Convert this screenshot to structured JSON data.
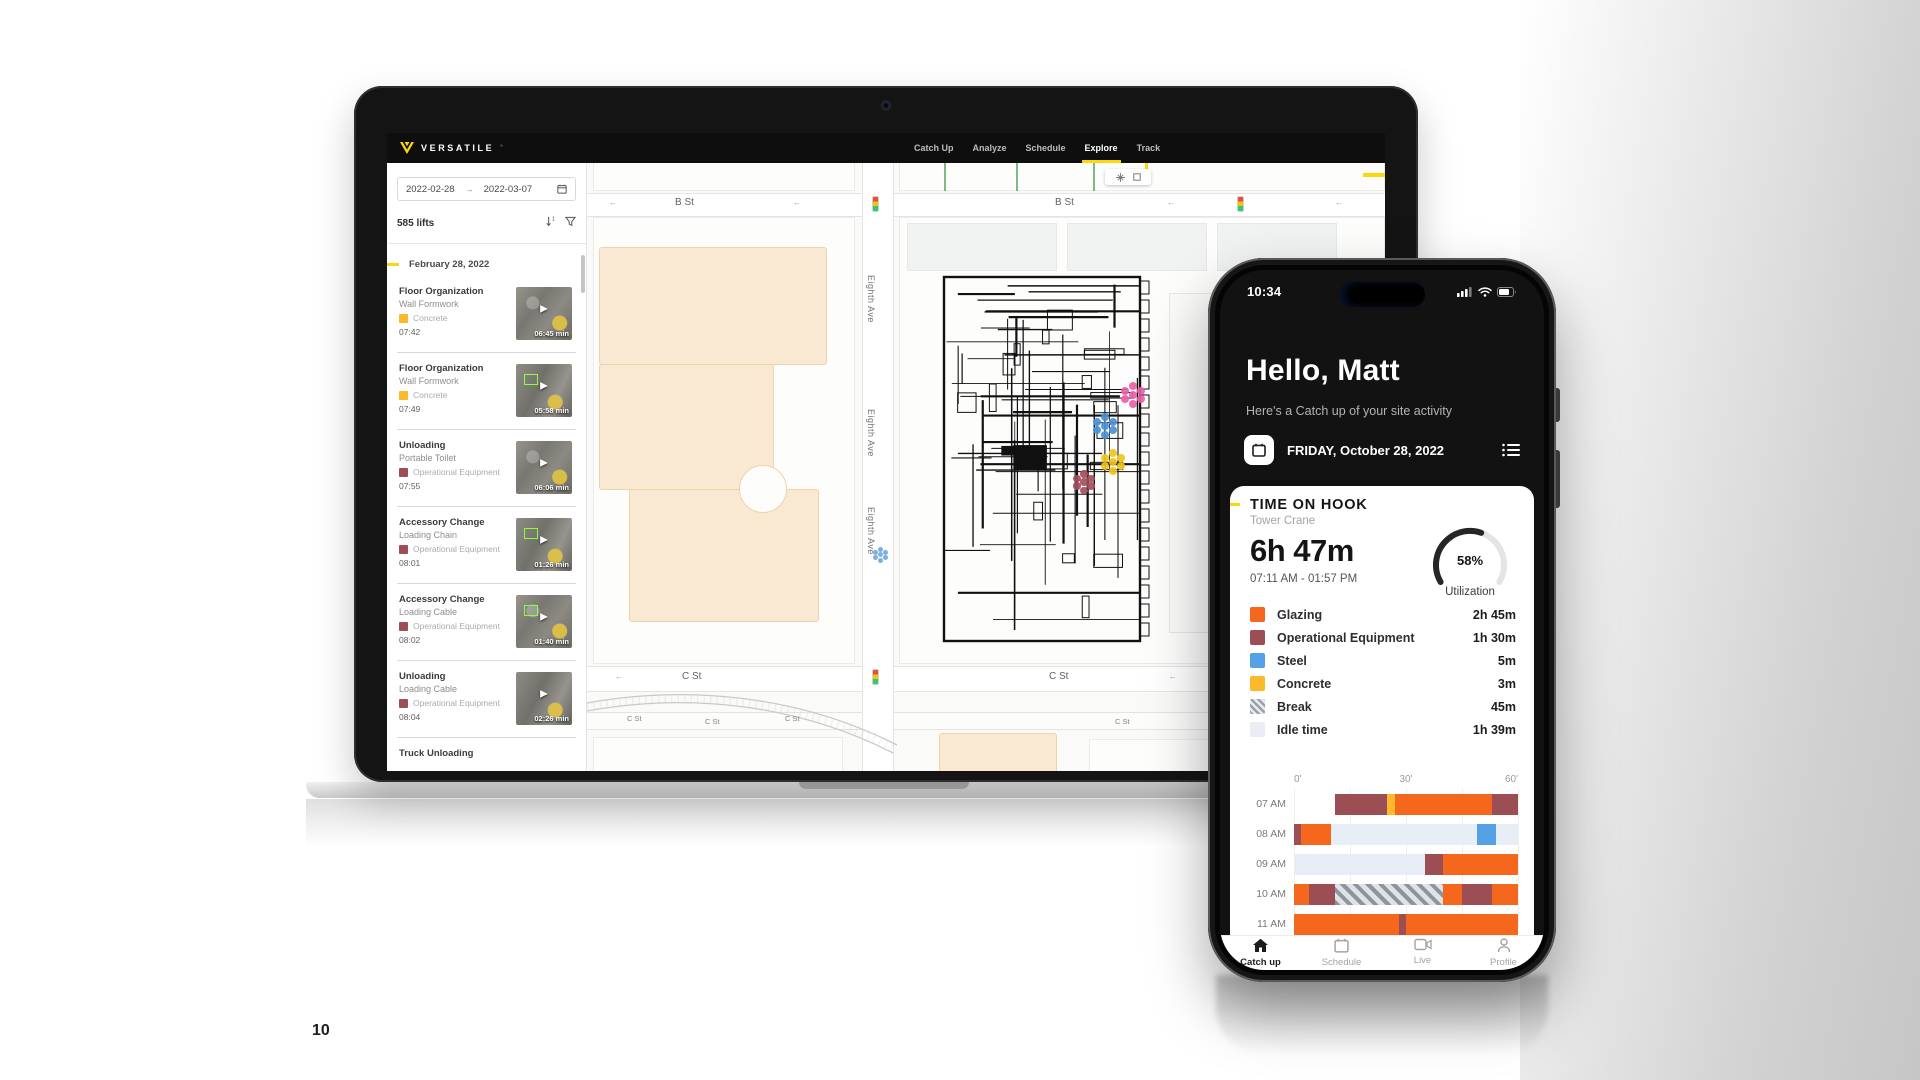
{
  "page": {
    "number": "10"
  },
  "colors": {
    "accent_yellow": "#FFD60A",
    "glazing": "#F4671C",
    "operational_equipment": "#9B4F55",
    "steel": "#54A1E6",
    "concrete": "#FCB92B",
    "break_stripe": "#99A0A8",
    "idle": "#E8EEF5"
  },
  "laptop": {
    "brand": "VERSATILE",
    "brand_mark": "°",
    "nav_items": [
      {
        "label": "Catch Up",
        "active": false
      },
      {
        "label": "Analyze",
        "active": false
      },
      {
        "label": "Schedule",
        "active": false
      },
      {
        "label": "Explore",
        "active": true
      },
      {
        "label": "Track",
        "active": false
      }
    ],
    "sidebar": {
      "date_from": "2022-02-28",
      "date_to": "2022-03-07",
      "lift_count": "585 lifts",
      "group_date": "February 28, 2022",
      "items": [
        {
          "title": "Floor Organization",
          "subtitle": "Wall Formwork",
          "category": "Concrete",
          "category_color": "#FCB92B",
          "time": "07:42",
          "duration": "06:45 min"
        },
        {
          "title": "Floor Organization",
          "subtitle": "Wall Formwork",
          "category": "Concrete",
          "category_color": "#FCB92B",
          "time": "07:49",
          "duration": "05:58 min"
        },
        {
          "title": "Unloading",
          "subtitle": "Portable Toilet",
          "category": "Operational Equipment",
          "category_color": "#9B4F55",
          "time": "07:55",
          "duration": "06:06 min"
        },
        {
          "title": "Accessory Change",
          "subtitle": "Loading Chain",
          "category": "Operational Equipment",
          "category_color": "#9B4F55",
          "time": "08:01",
          "duration": "01:26 min"
        },
        {
          "title": "Accessory Change",
          "subtitle": "Loading Cable",
          "category": "Operational Equipment",
          "category_color": "#9B4F55",
          "time": "08:02",
          "duration": "01:40 min"
        },
        {
          "title": "Unloading",
          "subtitle": "Loading Cable",
          "category": "Operational Equipment",
          "category_color": "#9B4F55",
          "time": "08:04",
          "duration": "02:26 min"
        },
        {
          "title": "Truck Unloading",
          "subtitle": "",
          "category": "",
          "category_color": "",
          "time": "",
          "duration": ""
        }
      ]
    },
    "map": {
      "street_b_labels": [
        "B St",
        "B St"
      ],
      "street_c_labels": [
        "C St",
        "C St"
      ],
      "street_c_small_labels": [
        "C St",
        "C St",
        "C St",
        "C St"
      ],
      "avenue_labels": [
        "Eighth Ave",
        "Eighth Ave",
        "Eighth Ave"
      ],
      "markers": [
        {
          "name": "cluster-pink",
          "color": "#EC5FA8",
          "x": 534,
          "y": 220,
          "size": 24
        },
        {
          "name": "cluster-blue",
          "color": "#4B8FD6",
          "x": 506,
          "y": 251,
          "size": 24
        },
        {
          "name": "cluster-yellow",
          "color": "#F2C31B",
          "x": 514,
          "y": 287,
          "size": 24
        },
        {
          "name": "cluster-maroon",
          "color": "#A34F5C",
          "x": 486,
          "y": 308,
          "size": 22
        },
        {
          "name": "cluster-small-blue",
          "color": "#6FA8DC",
          "x": 286,
          "y": 384,
          "size": 15
        }
      ]
    }
  },
  "phone": {
    "status_time": "10:34",
    "greeting": "Hello, Matt",
    "subtitle": "Here's a Catch up of your site activity",
    "date_label": "FRIDAY, October 28, 2022",
    "card": {
      "title": "TIME ON HOOK",
      "subtitle": "Tower Crane",
      "total_time": "6h 47m",
      "time_range": "07:11 AM - 01:57 PM",
      "utilization_pct": 58,
      "utilization_text": "58%",
      "utilization_label": "Utilization",
      "legend": [
        {
          "label": "Glazing",
          "value": "2h 45m",
          "color": "#F4671C",
          "pattern": "solid"
        },
        {
          "label": "Operational Equipment",
          "value": "1h 30m",
          "color": "#9B4F55",
          "pattern": "solid"
        },
        {
          "label": "Steel",
          "value": "5m",
          "color": "#54A1E6",
          "pattern": "solid"
        },
        {
          "label": "Concrete",
          "value": "3m",
          "color": "#FCB92B",
          "pattern": "solid"
        },
        {
          "label": "Break",
          "value": "45m",
          "color": "#99A0A8",
          "pattern": "stripes"
        },
        {
          "label": "Idle time",
          "value": "1h 39m",
          "color": "#E8EEF5",
          "pattern": "solid"
        }
      ]
    },
    "nav": [
      {
        "label": "Catch up",
        "icon": "home-icon",
        "active": true
      },
      {
        "label": "Schedule",
        "icon": "calendar-icon",
        "active": false
      },
      {
        "label": "Live",
        "icon": "video-icon",
        "active": false
      },
      {
        "label": "Profile",
        "icon": "profile-icon",
        "active": false
      }
    ]
  },
  "chart_data": {
    "type": "bar",
    "subtype": "horizontal-timeline",
    "title": "Time on hook by hour",
    "x_axis": {
      "tick_labels": [
        "0'",
        "30'",
        "60'"
      ],
      "range_minutes": [
        0,
        60
      ]
    },
    "categories_colors": {
      "Glazing": "#F4671C",
      "Operational Equipment": "#9B4F55",
      "Steel": "#54A1E6",
      "Concrete": "#FCB92B",
      "Break": "stripes",
      "Idle time": "#E8EEF5"
    },
    "rows": [
      {
        "label": "07 AM",
        "segments": [
          {
            "start": 11,
            "end": 25,
            "category": "Operational Equipment"
          },
          {
            "start": 25,
            "end": 27,
            "category": "Concrete"
          },
          {
            "start": 27,
            "end": 53,
            "category": "Glazing"
          },
          {
            "start": 53,
            "end": 60,
            "category": "Operational Equipment"
          }
        ]
      },
      {
        "label": "08 AM",
        "segments": [
          {
            "start": 0,
            "end": 2,
            "category": "Operational Equipment"
          },
          {
            "start": 2,
            "end": 10,
            "category": "Glazing"
          },
          {
            "start": 10,
            "end": 49,
            "category": "Idle time"
          },
          {
            "start": 49,
            "end": 54,
            "category": "Steel"
          },
          {
            "start": 54,
            "end": 60,
            "category": "Idle time"
          }
        ]
      },
      {
        "label": "09 AM",
        "segments": [
          {
            "start": 0,
            "end": 35,
            "category": "Idle time"
          },
          {
            "start": 35,
            "end": 40,
            "category": "Operational Equipment"
          },
          {
            "start": 40,
            "end": 60,
            "category": "Glazing"
          }
        ]
      },
      {
        "label": "10 AM",
        "segments": [
          {
            "start": 0,
            "end": 4,
            "category": "Glazing"
          },
          {
            "start": 4,
            "end": 11,
            "category": "Operational Equipment"
          },
          {
            "start": 11,
            "end": 40,
            "category": "Break"
          },
          {
            "start": 40,
            "end": 45,
            "category": "Glazing"
          },
          {
            "start": 45,
            "end": 53,
            "category": "Operational Equipment"
          },
          {
            "start": 53,
            "end": 60,
            "category": "Glazing"
          }
        ]
      },
      {
        "label": "11 AM",
        "segments": [
          {
            "start": 0,
            "end": 28,
            "category": "Glazing"
          },
          {
            "start": 28,
            "end": 30,
            "category": "Operational Equipment"
          },
          {
            "start": 30,
            "end": 60,
            "category": "Glazing"
          }
        ]
      }
    ],
    "gauge": {
      "value_pct": 58,
      "label": "Utilization"
    }
  }
}
